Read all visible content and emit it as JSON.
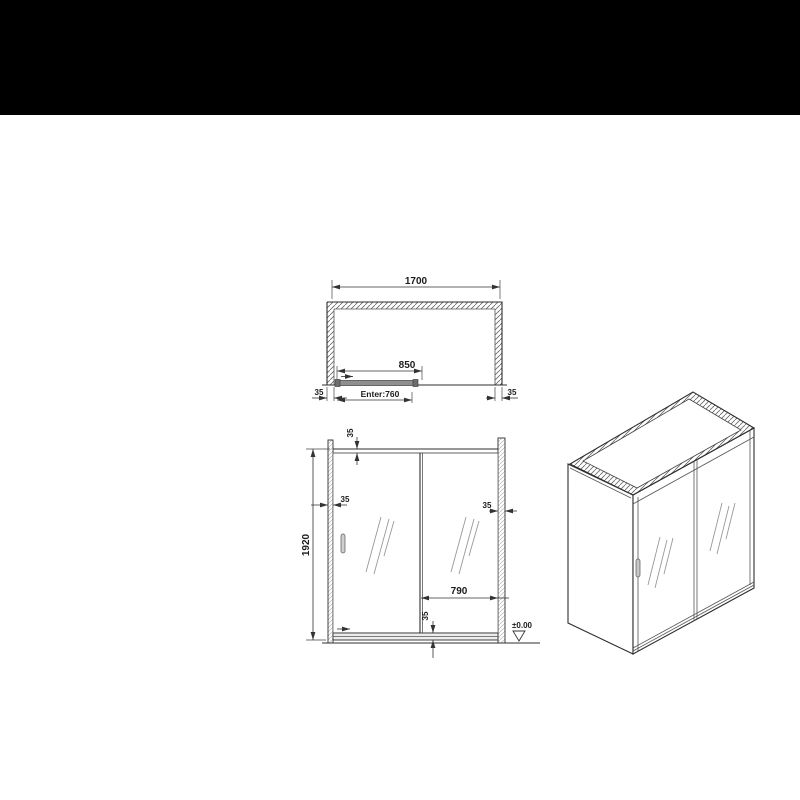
{
  "canvas": {
    "background": "#ffffff"
  },
  "top_banner": {
    "color": "#000000"
  },
  "drawing": {
    "line_color": "#2f2f2f",
    "plan_view": {
      "dim_overall_width": "1700",
      "dim_sliding_panel": "850",
      "dim_entry": "Enter:760",
      "dim_left_profile": "35",
      "dim_right_profile": "35"
    },
    "elevation_view": {
      "dim_overall_height": "1920",
      "dim_top_rail": "35",
      "dim_left_profile": "35",
      "dim_right_profile": "35",
      "dim_fixed_panel": "790",
      "dim_bottom_rail": "35",
      "dim_floor_level": "±0.00"
    }
  }
}
